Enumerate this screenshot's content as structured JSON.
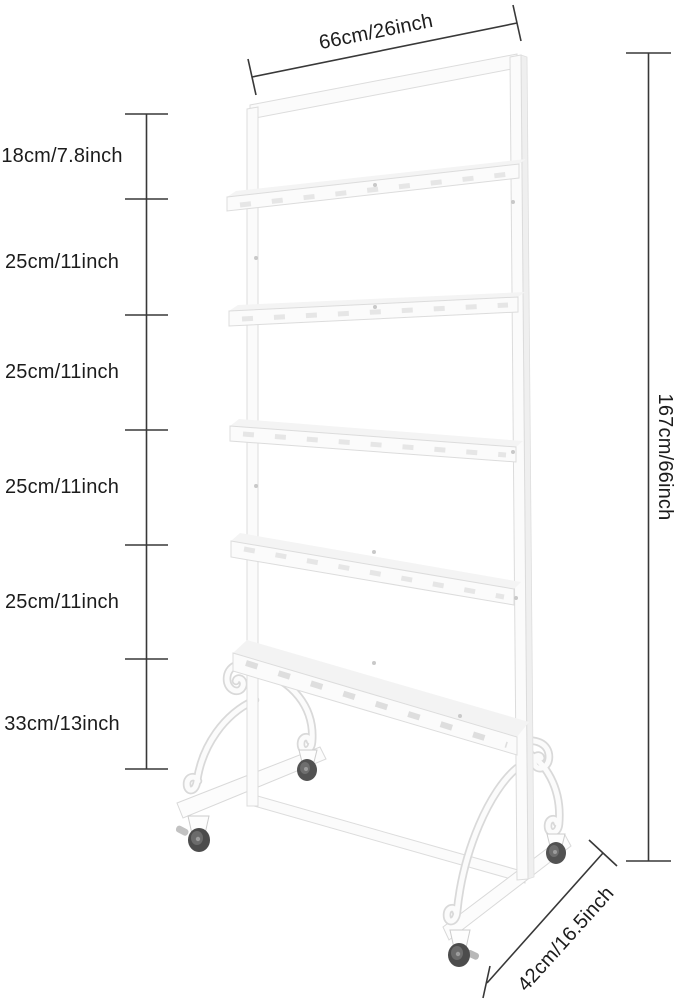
{
  "dimensions": {
    "top_width": "66cm/26inch",
    "overall_height": "167cm/66inch",
    "base_depth": "42cm/16.5inch",
    "left_sections": [
      "18cm/7.8inch",
      "25cm/11inch",
      "25cm/11inch",
      "25cm/11inch",
      "25cm/11inch",
      "33cm/13inch"
    ]
  },
  "colors": {
    "background": "#ffffff",
    "dimension_line": "#383838",
    "label_text": "#1c1c1c",
    "rack_outline": "#dcdcdc",
    "rack_fill": "#fbfbfb",
    "rack_shadow": "#f3f3f3",
    "wheel_dark": "#4f4f4f",
    "caster_metal": "#bdbdbd"
  }
}
